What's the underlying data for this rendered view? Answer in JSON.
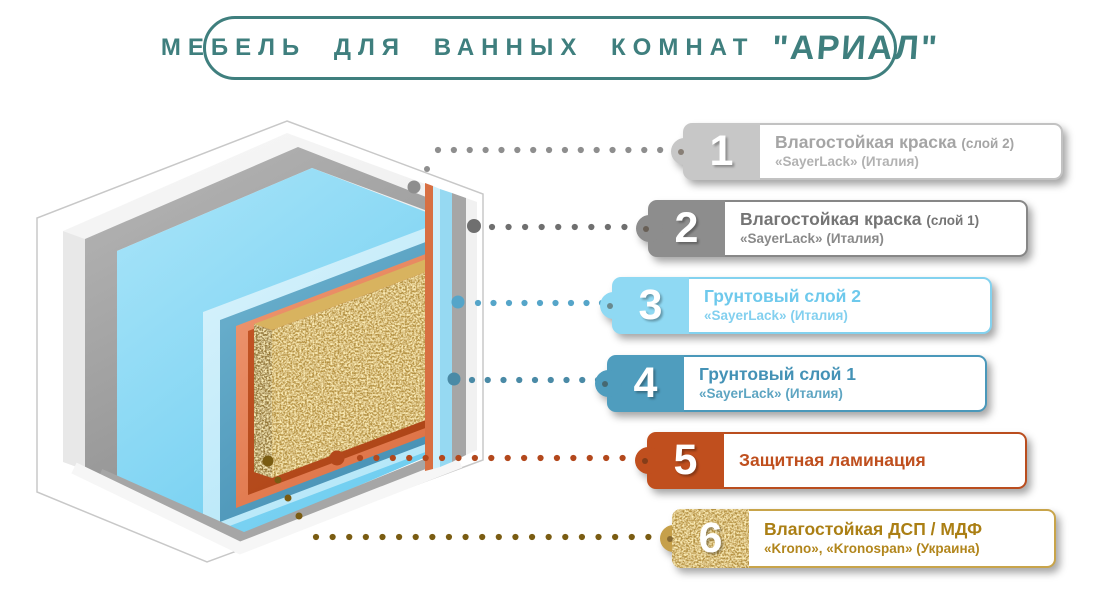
{
  "header": {
    "title": "МЕБЕЛЬ ДЛЯ ВАННЫХ КОМНАТ",
    "brand": "\"АРИАЛ\"",
    "accent_color": "#3f7f7e"
  },
  "callouts": [
    {
      "number": "1",
      "title": "Влагостойкая краска",
      "note": "(слой 2)",
      "subtitle": "«SayerLack» (Италия)",
      "tab_color": "#c7c7c7",
      "border_color": "#c2c2c2",
      "title_color": "#a5a5a5",
      "subtitle_color": "#b2b2b2",
      "dot_color": "#8e8e8e",
      "textured": false
    },
    {
      "number": "2",
      "title": "Влагостойкая краска",
      "note": "(слой 1)",
      "subtitle": "«SayerLack» (Италия)",
      "tab_color": "#8d8d8d",
      "border_color": "#878787",
      "title_color": "#757575",
      "subtitle_color": "#8a8a8a",
      "dot_color": "#6f6f6f",
      "textured": false
    },
    {
      "number": "3",
      "title": "Грунтовый слой 2",
      "note": "",
      "subtitle": "«SayerLack» (Италия)",
      "tab_color": "#8fd9f3",
      "border_color": "#83d2ef",
      "title_color": "#6ec9ec",
      "subtitle_color": "#83d0ef",
      "dot_color": "#55a5c9",
      "textured": false
    },
    {
      "number": "4",
      "title": "Грунтовый слой 1",
      "note": "",
      "subtitle": "«SayerLack» (Италия)",
      "tab_color": "#4f9dbe",
      "border_color": "#4a98ba",
      "title_color": "#4492b6",
      "subtitle_color": "#5ea5c2",
      "dot_color": "#4a8aa6",
      "textured": false
    },
    {
      "number": "5",
      "title": "Защитная ламинация",
      "note": "",
      "subtitle": "",
      "tab_color": "#c04f1e",
      "border_color": "#ba4d1e",
      "title_color": "#bf4f1e",
      "subtitle_color": "#bf4f1e",
      "dot_color": "#b3481c",
      "textured": false
    },
    {
      "number": "6",
      "title": "Влагостойкая ДСП / МДФ",
      "note": "",
      "subtitle": "«Krono», «Kronospan» (Украина)",
      "tab_color": "#c6a04a",
      "border_color": "#c8a44a",
      "title_color": "#ab7f14",
      "subtitle_color": "#b2861c",
      "dot_color": "#7a5c12",
      "textured": true
    }
  ],
  "diagram": {
    "layers": [
      {
        "id": "paint2",
        "label": "влагостойкая краска слой 2",
        "color": "#f3f3f3"
      },
      {
        "id": "paint1",
        "label": "влагостойкая краска слой 1",
        "color": "#a6a6a6"
      },
      {
        "id": "primer2",
        "label": "грунтовый слой 2",
        "color": "#8ed9f5"
      },
      {
        "id": "primer1",
        "label": "грунтовый слой 1",
        "color": "#4f9dbe"
      },
      {
        "id": "lamination",
        "label": "защитная ламинация",
        "color": "#df7347"
      },
      {
        "id": "chipboard",
        "label": "влагостойкая ДСП / МДФ",
        "color": "#bb943a"
      }
    ]
  }
}
